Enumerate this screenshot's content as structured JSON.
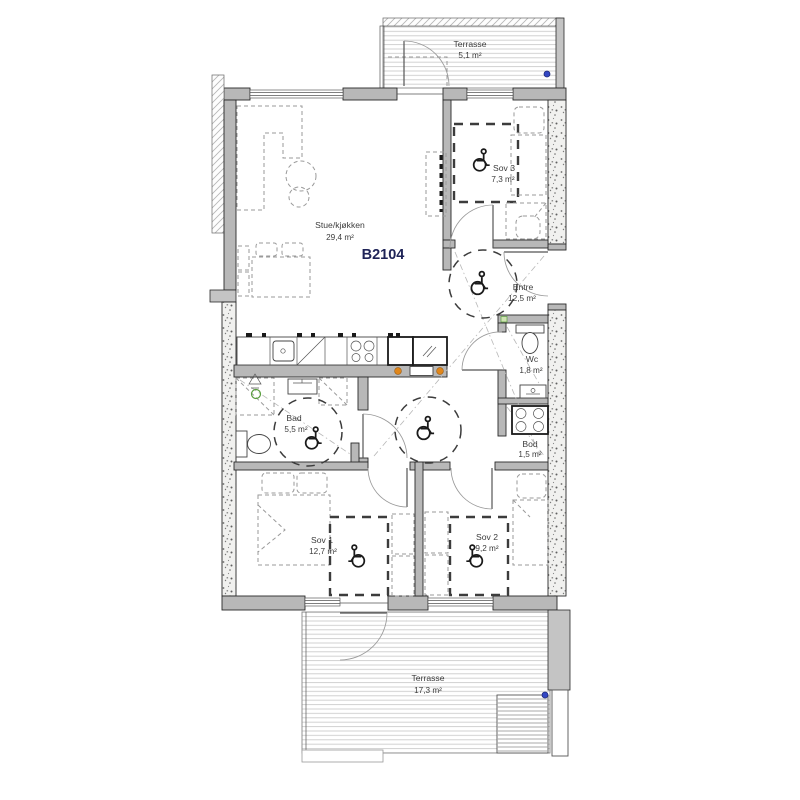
{
  "plan": {
    "apartment_id": "B2104",
    "rooms": [
      {
        "id": "terrasse-top",
        "name": "Terrasse",
        "area": "5,1 m²"
      },
      {
        "id": "stue-kjokken",
        "name": "Stue/kjøkken",
        "area": "29,4 m²"
      },
      {
        "id": "sov-3",
        "name": "Sov 3",
        "area": "7,3 m²"
      },
      {
        "id": "entre",
        "name": "Entre",
        "area": "12,5 m²"
      },
      {
        "id": "wc",
        "name": "Wc",
        "area": "1,8 m²"
      },
      {
        "id": "bad",
        "name": "Bad",
        "area": "5,5 m²"
      },
      {
        "id": "bod",
        "name": "Bod",
        "area": "1,5 m²"
      },
      {
        "id": "sov-1",
        "name": "Sov 1",
        "area": "12,7 m²"
      },
      {
        "id": "sov-2",
        "name": "Sov 2",
        "area": "9,2 m²"
      },
      {
        "id": "terrasse-bottom",
        "name": "Terrasse",
        "area": "17,3 m²"
      }
    ],
    "icons": {
      "wheelchair": "wheelchair-accessible-turning-area",
      "drain_marker": "blue-drain-dot",
      "shower": "shower-corner",
      "stove": "stove-4-burners"
    },
    "colors": {
      "apartment_id_text": "#1e2357",
      "wall_fill": "#b8b8b8",
      "outline": "#2a2a2a",
      "socket_orange": "#e0861a",
      "drain_blue": "#3347c4",
      "drain_green": "#5a9e3f",
      "furniture_dash": "#9a9a9a"
    }
  }
}
